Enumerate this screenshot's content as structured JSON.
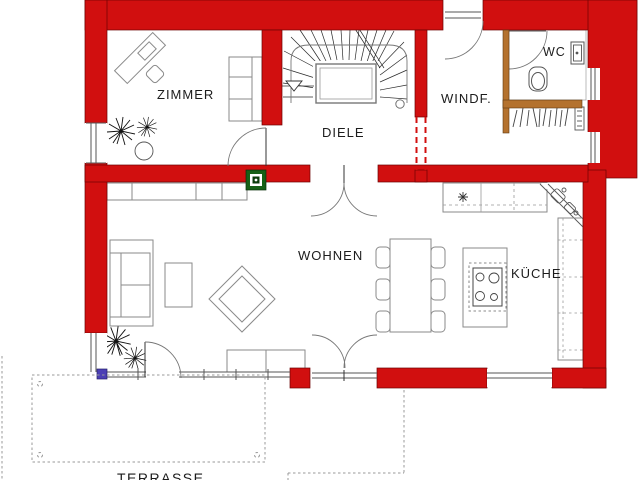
{
  "plan": {
    "rooms": {
      "zimmer": {
        "label": "ZIMMER"
      },
      "diele": {
        "label": "DIELE"
      },
      "windfang": {
        "label": "WINDF."
      },
      "wc": {
        "label": "WC"
      },
      "wohnen": {
        "label": "WOHNEN"
      },
      "kueche": {
        "label": "KÜCHE"
      },
      "terrasse": {
        "label": "TERRASSE"
      }
    },
    "colors": {
      "wall": "#d10f0f",
      "wood": "#b4722e",
      "chimney": "#166016",
      "downpipe": "#4b3fb5"
    }
  }
}
